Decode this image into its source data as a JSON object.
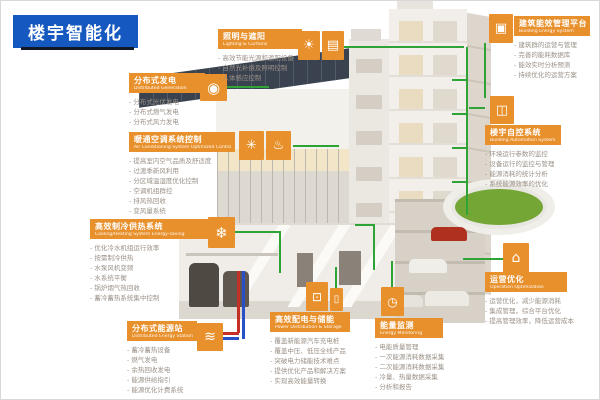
{
  "title": {
    "text": "楼宇智能化"
  },
  "colors": {
    "accent_orange": "#E8902C",
    "title_blue": "#1558C0",
    "line_green": "#2FA335",
    "item_gray": "#9B9188",
    "pipe_red": "#C43026",
    "pipe_blue": "#2A50C8",
    "roof_green": "#74A636"
  },
  "sections": [
    {
      "id": "distributed-generation",
      "title_cn": "分布式发电",
      "title_en": "Distributed Generation",
      "icons": [
        {
          "name": "bulb-icon",
          "glyph": "◉"
        }
      ],
      "items": [
        "分布式光伏发电",
        "分布式燃气发电",
        "分布式风力发电"
      ]
    },
    {
      "id": "lighting-curtains",
      "title_cn": "照明与遮阳",
      "title_en": "Lighting & Curtains",
      "icons": [
        {
          "name": "sun-icon",
          "glyph": "☀"
        },
        {
          "name": "blinds-icon",
          "glyph": "▤"
        }
      ],
      "items": [
        "高效节能光源和遮阳设备",
        "自然光补偿及照明控制",
        "人体感应控制"
      ]
    },
    {
      "id": "building-energy-platform",
      "title_cn": "建筑能效管理平台",
      "title_en": "Building Energy System",
      "icons": [
        {
          "name": "computer-icon",
          "glyph": "▣"
        }
      ],
      "items": [
        "建筑群的运营与管理",
        "完善的能耗数据库",
        "能效实时分析预测",
        "持续优化的运营方案"
      ]
    },
    {
      "id": "building-automation",
      "title_cn": "楼宇自控系统",
      "title_en": "Building Automation System",
      "icons": [
        {
          "name": "window-panels-icon",
          "glyph": "◫"
        }
      ],
      "items": [
        "环境运行参数的监控",
        "设备运行的监控与管理",
        "能源消耗的统计分析",
        "系统能源效率的优化"
      ]
    },
    {
      "id": "hvac-control",
      "title_cn": "暖通空调系统控制",
      "title_en": "Air Conditioning System Optimized Control",
      "icons": [
        {
          "name": "fan-icon",
          "glyph": "✳"
        },
        {
          "name": "thermometer-icon",
          "glyph": "♨"
        }
      ],
      "items": [
        "提高室内空气品质及舒适度",
        "过渡季新风利用",
        "分区域温湿度优化控制",
        "空调机组群控",
        "排风热回收",
        "变风量系统"
      ]
    },
    {
      "id": "cooling-heating",
      "title_cn": "高效制冷供热系统",
      "title_en": "Cooling/Heating System Energy-saving",
      "icons": [
        {
          "name": "snowflake-icon",
          "glyph": "❄"
        }
      ],
      "items": [
        "优化冷水机组运行效率",
        "按需制冷供热",
        "水泵风机变频",
        "水系统平衡",
        "锅炉烟气热回收",
        "蓄冷蓄热系统集中控制"
      ]
    },
    {
      "id": "distributed-energy-station",
      "title_cn": "分布式能源站",
      "title_en": "Distributed Energy Station",
      "icons": [
        {
          "name": "pipes-icon",
          "glyph": "≋"
        }
      ],
      "items": [
        "蓄冷蓄热设备",
        "燃气发电",
        "余热回收发电",
        "能源供给指引",
        "能源优化计费系统"
      ]
    },
    {
      "id": "power-distribution-storage",
      "title_cn": "高效配电与储能",
      "title_en": "Power Distribution & Storage",
      "icons": [
        {
          "name": "monitor-icon",
          "glyph": "⊡"
        },
        {
          "name": "battery-icon",
          "glyph": "▯"
        }
      ],
      "items": [
        "覆盖新能源汽车充电桩",
        "覆盖中压、低压全线产品",
        "突破电力储能技术难点",
        "提供优化产品和解决方案",
        "实现高效能量转换"
      ]
    },
    {
      "id": "energy-monitoring",
      "title_cn": "能量监测",
      "title_en": "Energy Monitoring",
      "icons": [
        {
          "name": "meter-icon",
          "glyph": "◷"
        }
      ],
      "items": [
        "电能质量管理",
        "一次能源消耗数据采集",
        "二次能源消耗数据采集",
        "冷量、热量数据采集",
        "分析和报告"
      ]
    },
    {
      "id": "operation-optimization",
      "title_cn": "运营优化",
      "title_en": "Operation Optimization",
      "icons": [
        {
          "name": "house-display-icon",
          "glyph": "⌂"
        }
      ],
      "items": [
        "运营优化，减少能源消耗",
        "集成管理，综合平台优化",
        "提高管理效率，降低运营成本"
      ]
    }
  ]
}
